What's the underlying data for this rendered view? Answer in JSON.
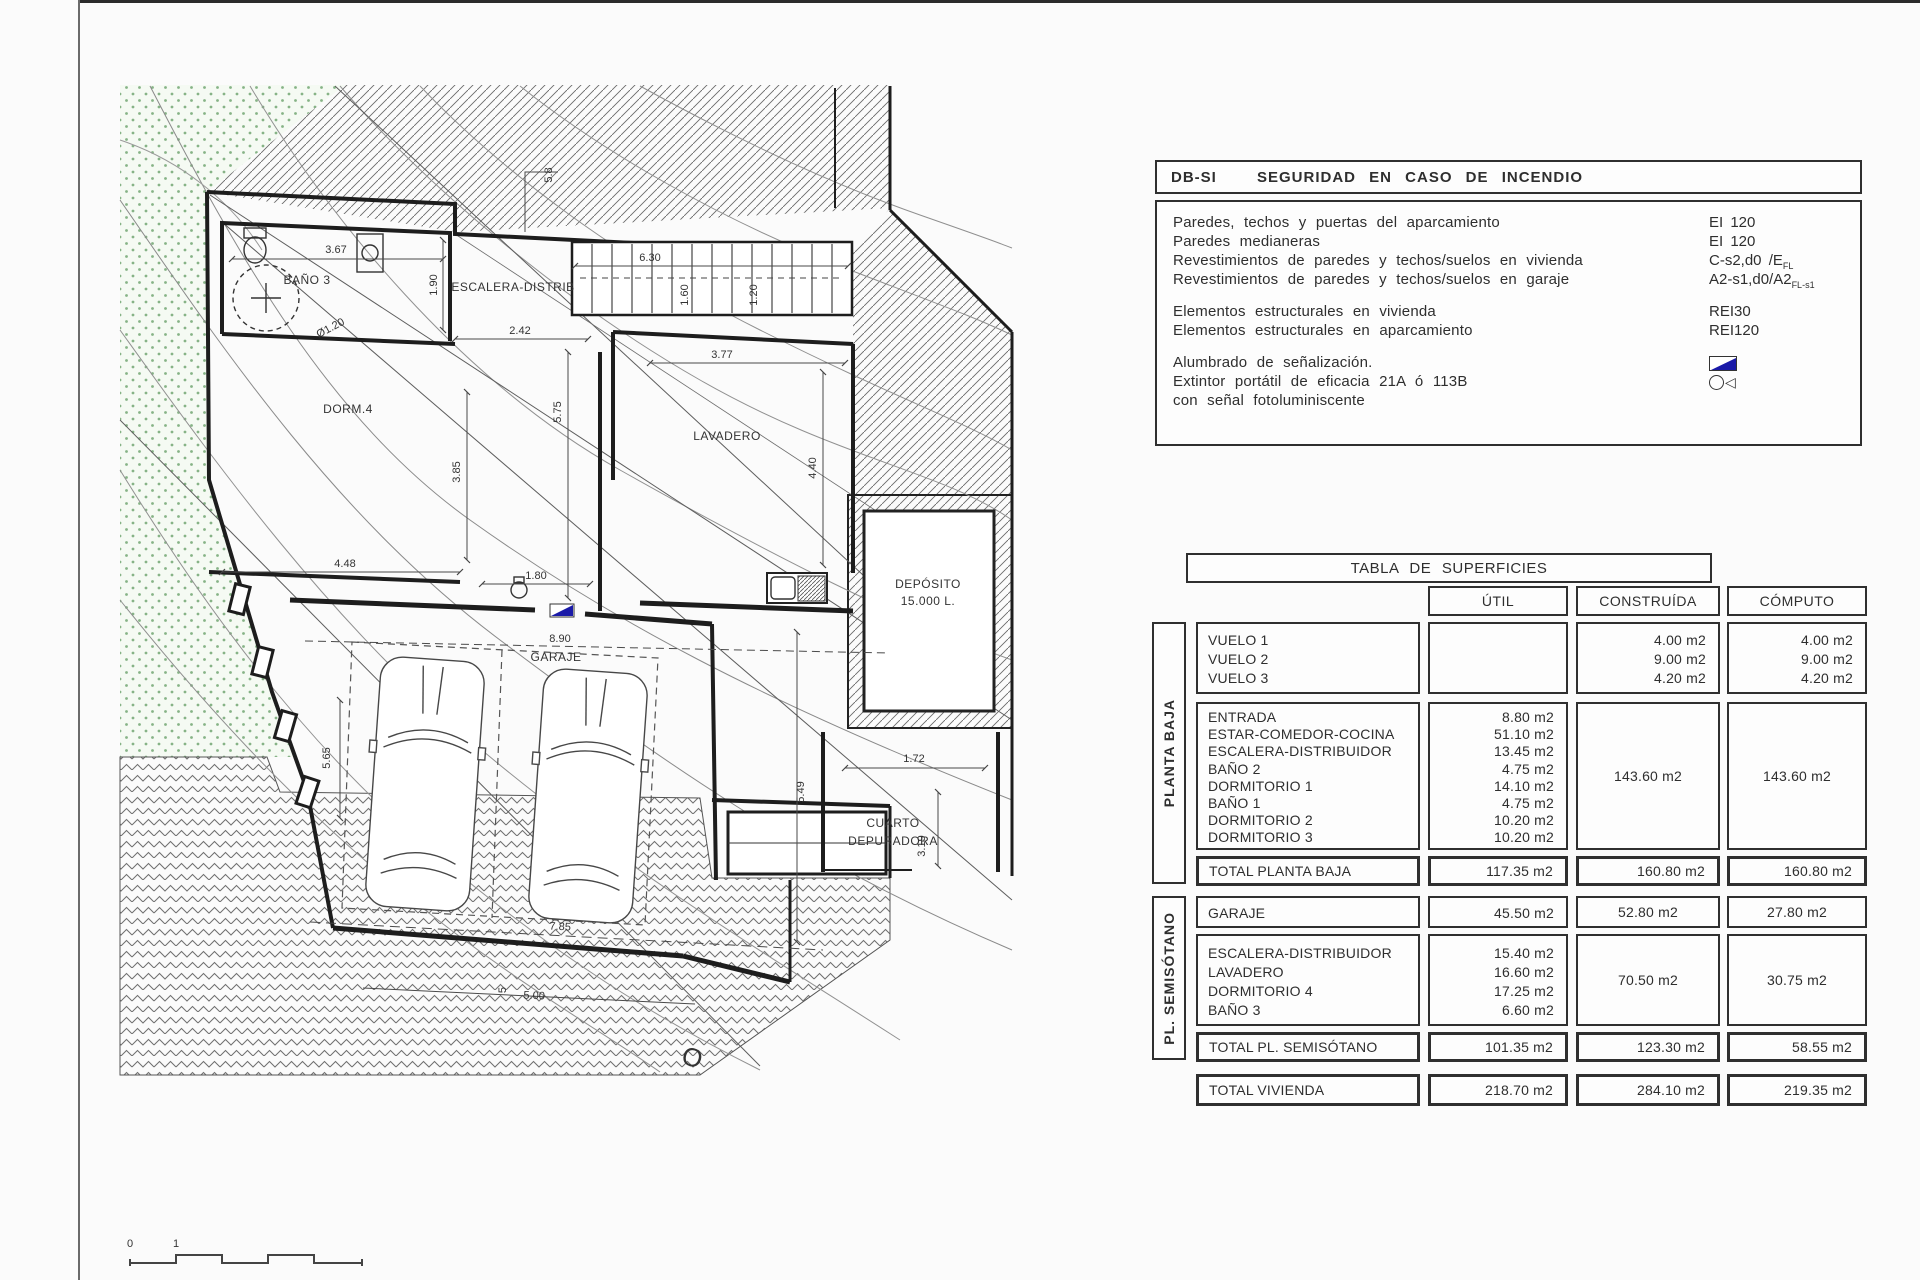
{
  "fire_table": {
    "code": "DB-SI",
    "title": "SEGURIDAD EN CASO DE INCENDIO",
    "rows": [
      {
        "label": "Paredes, techos y puertas del aparcamiento",
        "value": "EI 120"
      },
      {
        "label": "Paredes medianeras",
        "value": "EI 120"
      },
      {
        "label": "Revestimientos de paredes y techos/suelos en vivienda",
        "value": "C-s2,d0 /E",
        "value_sub": "FL"
      },
      {
        "label": "Revestimientos de paredes y techos/suelos en garaje",
        "value": "A2-s1,d0/A2",
        "value_sub": "FL-s1"
      },
      {
        "spacer": true
      },
      {
        "label": "Elementos estructurales en vivienda",
        "value": "REI30"
      },
      {
        "label": "Elementos estructurales en aparcamiento",
        "value": "REI120"
      },
      {
        "spacer": true
      },
      {
        "label": "Alumbrado de señalización.",
        "icon": "signal-lamp"
      },
      {
        "label": "Extintor portátil de eficacia 21A ó 113B",
        "icon": "extinguisher"
      },
      {
        "label": "con señal fotoluminiscente"
      }
    ]
  },
  "surfaces_table": {
    "title": "TABLA DE SUPERFICIES",
    "columns": [
      "ÚTIL",
      "CONSTRUÍDA",
      "CÓMPUTO"
    ],
    "side_labels": [
      "PLANTA BAJA",
      "PL. SEMISÓTANO"
    ],
    "blocks": [
      {
        "id": "vuelos",
        "rows": [
          {
            "label": "VUELO 1",
            "construida": "4.00 m2",
            "computo": "4.00 m2"
          },
          {
            "label": "VUELO 2",
            "construida": "9.00 m2",
            "computo": "9.00 m2"
          },
          {
            "label": "VUELO 3",
            "construida": "4.20 m2",
            "computo": "4.20 m2"
          }
        ]
      },
      {
        "id": "pb",
        "rows": [
          {
            "label": "ENTRADA",
            "util": "8.80 m2"
          },
          {
            "label": "ESTAR-COMEDOR-COCINA",
            "util": "51.10 m2"
          },
          {
            "label": "ESCALERA-DISTRIBUIDOR",
            "util": "13.45 m2"
          },
          {
            "label": "BAÑO 2",
            "util": "4.75 m2"
          },
          {
            "label": "DORMITORIO 1",
            "util": "14.10 m2"
          },
          {
            "label": "BAÑO 1",
            "util": "4.75 m2"
          },
          {
            "label": "DORMITORIO 2",
            "util": "10.20 m2"
          },
          {
            "label": "DORMITORIO 3",
            "util": "10.20 m2"
          }
        ],
        "construida": "143.60 m2",
        "computo": "143.60 m2"
      },
      {
        "id": "total_pb",
        "total": true,
        "label": "TOTAL PLANTA BAJA",
        "util": "117.35 m2",
        "construida": "160.80 m2",
        "computo": "160.80 m2"
      },
      {
        "id": "garaje",
        "rows": [
          {
            "label": "GARAJE",
            "util": "45.50 m2"
          }
        ],
        "construida": "52.80 m2",
        "computo": "27.80 m2"
      },
      {
        "id": "ps",
        "rows": [
          {
            "label": "ESCALERA-DISTRIBUIDOR",
            "util": "15.40 m2"
          },
          {
            "label": "LAVADERO",
            "util": "16.60 m2"
          },
          {
            "label": "DORMITORIO 4",
            "util": "17.25 m2"
          },
          {
            "label": "BAÑO 3",
            "util": "6.60 m2"
          }
        ],
        "construida": "70.50 m2",
        "computo": "30.75 m2"
      },
      {
        "id": "total_ps",
        "total": true,
        "label": "TOTAL PL. SEMISÓTANO",
        "util": "101.35 m2",
        "construida": "123.30 m2",
        "computo": "58.55 m2"
      },
      {
        "id": "total_viv",
        "total": true,
        "label": "TOTAL VIVIENDA",
        "util": "218.70 m2",
        "construida": "284.10 m2",
        "computo": "219.35 m2"
      }
    ]
  },
  "plan": {
    "room_labels": [
      {
        "text": "BAÑO 3",
        "x": 307,
        "y": 284
      },
      {
        "text": "DORM.4",
        "x": 348,
        "y": 413
      },
      {
        "text": "ESCALERA-DISTRIB",
        "x": 513,
        "y": 291
      },
      {
        "text": "LAVADERO",
        "x": 727,
        "y": 440
      },
      {
        "text": "GARAJE",
        "x": 556,
        "y": 661
      },
      {
        "text": "DEPÓSITO",
        "x": 928,
        "y": 588
      },
      {
        "text": "15.000 L.",
        "x": 928,
        "y": 605
      },
      {
        "text": "CUARTO",
        "x": 893,
        "y": 827
      },
      {
        "text": "DEPURADORA",
        "x": 893,
        "y": 845
      }
    ],
    "dimensions": [
      {
        "text": "3.67",
        "x": 336,
        "y": 253
      },
      {
        "text": "1.90",
        "x": 437,
        "y": 285,
        "rot": -90
      },
      {
        "text": "5.8",
        "x": 552,
        "y": 175,
        "rot": -90
      },
      {
        "text": "6.30",
        "x": 650,
        "y": 261
      },
      {
        "text": "1.60",
        "x": 688,
        "y": 295,
        "rot": -90
      },
      {
        "text": "1.20",
        "x": 757,
        "y": 295,
        "rot": -90
      },
      {
        "text": "2.42",
        "x": 520,
        "y": 334
      },
      {
        "text": "3.77",
        "x": 722,
        "y": 358
      },
      {
        "text": "5.75",
        "x": 561,
        "y": 412,
        "rot": -90
      },
      {
        "text": "3.85",
        "x": 460,
        "y": 472,
        "rot": -90
      },
      {
        "text": "4.40",
        "x": 816,
        "y": 468,
        "rot": -90
      },
      {
        "text": "4.48",
        "x": 345,
        "y": 567
      },
      {
        "text": "1.80",
        "x": 536,
        "y": 579
      },
      {
        "text": "8.90",
        "x": 560,
        "y": 642
      },
      {
        "text": "5.65",
        "x": 330,
        "y": 758,
        "rot": -90
      },
      {
        "text": "5.49",
        "x": 804,
        "y": 792,
        "rot": -90
      },
      {
        "text": "1.72",
        "x": 914,
        "y": 762
      },
      {
        "text": "3.19",
        "x": 925,
        "y": 846,
        "rot": -90
      },
      {
        "text": "7.85",
        "x": 560,
        "y": 930,
        "rot": 3
      },
      {
        "text": "5",
        "x": 506,
        "y": 990,
        "rot": -90
      },
      {
        "text": "5.00",
        "x": 534,
        "y": 999,
        "rot": 3
      },
      {
        "text": "Ø1.20",
        "x": 332,
        "y": 331,
        "rot": -28
      },
      {
        "text": "O",
        "x": 690,
        "y": 1066,
        "rot": 15,
        "size": 26
      }
    ],
    "scale_labels": [
      {
        "text": "0",
        "x": 130,
        "y": 1247
      },
      {
        "text": "1",
        "x": 176,
        "y": 1247
      }
    ]
  }
}
